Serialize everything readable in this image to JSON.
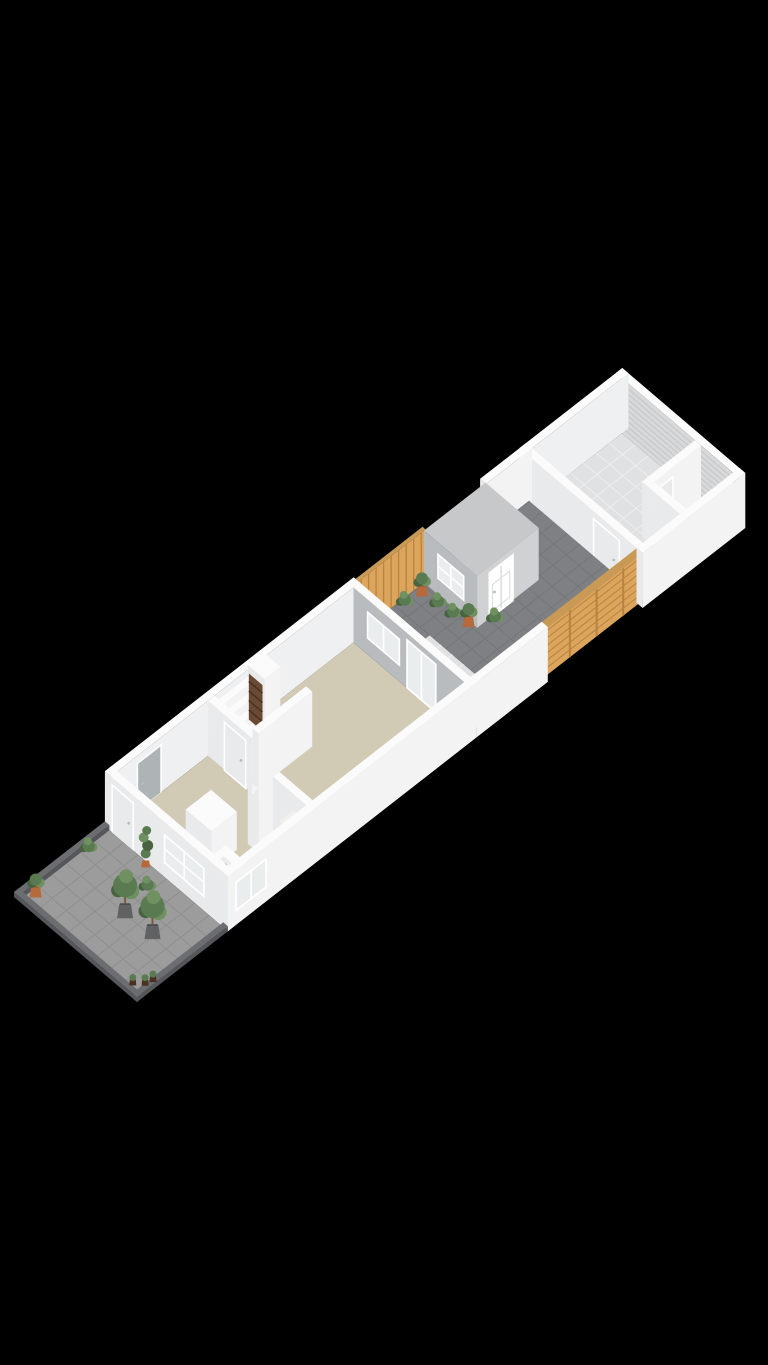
{
  "canvas": {
    "width": 768,
    "height": 1365,
    "background": "#000000",
    "viewbox": "0 0 768 1365"
  },
  "view": {
    "type": "isometric-3d-floorplan",
    "floor_label": ""
  },
  "projection": {
    "origin": [
      137,
      1002
    ],
    "u": [
      0.79,
      -0.6156
    ],
    "v": [
      -0.759,
      -0.648
    ],
    "wall_height": 55
  },
  "palette": {
    "bg": "#000000",
    "white": "#f6f6f7",
    "whiteTop": "#fbfbfc",
    "whiteFaceU": "#e9eaec",
    "whiteFaceV": "#f3f3f4",
    "innerWhite": "#eef0f1",
    "beige": "#d1cab5",
    "tile": "#dfe1e3",
    "tileLine": "#eef0f2",
    "paver": "#7e8083",
    "paverLine": "#737577",
    "terr": "#9c9c9c",
    "terrLine": "#8d8d8d",
    "curb": "#6b6d70",
    "curbSide": "#55575a",
    "wood": "#dca55e",
    "woodDark": "#b9823e",
    "woodTop": "#c99a55",
    "gray": "#b9bcbe",
    "shedSide": "#cfd1d3",
    "roof": "#c6c8ca",
    "glass": "#e9edee",
    "frame": "#ffffff",
    "rib": "#d7d9db",
    "ribLine": "#c5c7c9",
    "smFloor": "#b4b7b9",
    "counterTop": "#ececed",
    "burner": "#3f4143",
    "green": "#5a7a52",
    "greenD": "#47633f",
    "greenL": "#6f9161",
    "terra": "#b66a3c",
    "terraD": "#96522c",
    "planter": "#5f6163",
    "brown": "#6b4a33",
    "brownD": "#4a3122",
    "door": "#e9eaeb",
    "doorOpen": "#aeb3b6",
    "mat": "#f2f1ee"
  },
  "scene": [
    {
      "n": "garage-ribbed-wall",
      "t": "face",
      "ax": "u",
      "at": 762,
      "c": [
        8,
        154
      ],
      "h": [
        0,
        55
      ],
      "f": "rib",
      "stripes": [
        {
          "dir": "h",
          "step": 5.5,
          "col": "ribLine",
          "w": 1.2
        }
      ]
    },
    {
      "n": "garage-far-wall-top",
      "t": "floor",
      "u": [
        762,
        770
      ],
      "v": [
        0,
        162
      ],
      "h": 55,
      "f": "whiteTop"
    },
    {
      "n": "garage-back-wall-inner",
      "t": "face",
      "ax": "v",
      "at": 154,
      "c": [
        640,
        770
      ],
      "h": [
        0,
        55
      ],
      "f": "innerWhite"
    },
    {
      "n": "garage-back-wall-top",
      "t": "floor",
      "u": [
        640,
        770
      ],
      "v": [
        154,
        162
      ],
      "h": 55,
      "f": "whiteTop"
    },
    {
      "n": "garage-floor",
      "t": "floor",
      "u": [
        648,
        762
      ],
      "v": [
        50,
        154
      ],
      "h": 0,
      "f": "tile",
      "grid": [
        16.3,
        17.3,
        "tileLine"
      ]
    },
    {
      "n": "garage-entry-floor",
      "t": "floor",
      "u": [
        648,
        695
      ],
      "v": [
        8,
        50
      ],
      "h": 0,
      "f": "tile",
      "grid": [
        15.6,
        14,
        "tileLine"
      ]
    },
    {
      "n": "storage-room-floor",
      "t": "floor",
      "u": [
        695,
        762
      ],
      "v": [
        8,
        50
      ],
      "h": 0,
      "f": "smFloor"
    },
    {
      "n": "storage-room-wall-long",
      "t": "box",
      "u": [
        695,
        762
      ],
      "v": [
        50,
        58
      ],
      "h": [
        0,
        55
      ]
    },
    {
      "n": "storage-room-door",
      "t": "door",
      "ax": "v",
      "at": 49.5,
      "c": [
        702,
        726
      ],
      "h": [
        0,
        46
      ],
      "f": "door"
    },
    {
      "n": "storage-room-wall-cross",
      "t": "box",
      "u": [
        695,
        703
      ],
      "v": [
        8,
        50
      ],
      "h": [
        0,
        55
      ]
    },
    {
      "n": "garage-front-wall",
      "t": "box",
      "u": [
        640,
        648
      ],
      "v": [
        8,
        162
      ],
      "h": [
        0,
        55
      ]
    },
    {
      "n": "garage-entry-door",
      "t": "door",
      "ax": "u",
      "at": 639.5,
      "c": [
        30,
        64
      ],
      "h": [
        0,
        48
      ],
      "f": "door"
    },
    {
      "n": "courtyard-back-wall",
      "t": "box",
      "u": [
        590,
        648
      ],
      "v": [
        154,
        162
      ],
      "h": [
        0,
        55
      ]
    },
    {
      "n": "courtyard-fence-left",
      "t": "face",
      "ax": "v",
      "at": 158,
      "c": [
        426,
        517
      ],
      "h": [
        0,
        52
      ],
      "f": "wood",
      "stripes": [
        {
          "dir": "plan",
          "step": 9.5,
          "col": "woodDark",
          "w": 1.3
        }
      ]
    },
    {
      "n": "courtyard-fence-left-top",
      "t": "floor",
      "u": [
        426,
        517
      ],
      "v": [
        158,
        162
      ],
      "h": 52,
      "f": "woodTop"
    },
    {
      "n": "courtyard-paving",
      "t": "floor",
      "u": [
        478,
        648
      ],
      "v": [
        8,
        158
      ],
      "h": 0,
      "f": "paver",
      "grid": [
        17,
        16.6,
        "paverLine"
      ]
    },
    {
      "n": "courtyard-paving-upper",
      "t": "floor",
      "u": [
        430,
        478
      ],
      "v": [
        112,
        158
      ],
      "h": 0,
      "f": "paver",
      "grid": [
        16,
        15.3,
        "paverLine"
      ]
    },
    {
      "n": "garden-shed-window-wall",
      "t": "face",
      "ax": "u",
      "at": 515,
      "c": [
        88,
        158
      ],
      "h": [
        0,
        52
      ],
      "f": "gray"
    },
    {
      "n": "garden-shed-window",
      "t": "win",
      "ax": "u",
      "at": 514.5,
      "c": [
        104,
        140
      ],
      "h": [
        16,
        42
      ],
      "mull": [
        2,
        2
      ]
    },
    {
      "n": "garden-shed-side-wall",
      "t": "face",
      "ax": "v",
      "at": 88,
      "c": [
        515,
        593
      ],
      "h": [
        0,
        52
      ],
      "f": "shedSide"
    },
    {
      "n": "garden-shed-door",
      "t": "door",
      "ax": "v",
      "at": 87.5,
      "c": [
        530,
        560
      ],
      "h": [
        0,
        46
      ],
      "f": "frame",
      "panels": true
    },
    {
      "n": "garden-shed-roof",
      "t": "floor",
      "u": [
        515,
        593
      ],
      "v": [
        88,
        158
      ],
      "h": 52,
      "f": "roof"
    },
    {
      "n": "courtyard-plant",
      "t": "plant",
      "k": "bush",
      "p": [
        485,
        152
      ]
    },
    {
      "n": "courtyard-potted-plant",
      "t": "plant",
      "k": "pot",
      "p": [
        503,
        148
      ]
    },
    {
      "n": "courtyard-plant",
      "t": "plant",
      "k": "bush",
      "p": [
        506,
        130
      ]
    },
    {
      "n": "courtyard-plant",
      "t": "plant",
      "k": "bush",
      "p": [
        508,
        112
      ]
    },
    {
      "n": "courtyard-potted-plant",
      "t": "plant",
      "k": "pot",
      "p": [
        510,
        94
      ]
    },
    {
      "n": "courtyard-plant",
      "t": "plant",
      "k": "bush",
      "p": [
        532,
        82
      ]
    },
    {
      "n": "courtyard-fence-right",
      "t": "face",
      "ax": "v",
      "at": 6,
      "c": [
        520,
        655
      ],
      "h": [
        0,
        52
      ],
      "f": "wood",
      "stripes": [
        {
          "dir": "h",
          "step": 7.4,
          "col": "woodDark",
          "w": 1
        },
        {
          "dir": "plan",
          "step": 33.75,
          "col": "woodDark",
          "w": 2
        }
      ]
    },
    {
      "n": "courtyard-fence-right-top",
      "t": "floor",
      "u": [
        520,
        655
      ],
      "v": [
        2,
        10
      ],
      "h": 52,
      "f": "woodTop"
    },
    {
      "n": "garage-right-wall",
      "t": "box",
      "u": [
        640,
        770
      ],
      "v": [
        0,
        8
      ],
      "h": [
        0,
        55
      ]
    },
    {
      "n": "patio-tiles",
      "t": "floor",
      "u": [
        430,
        478
      ],
      "v": [
        8,
        112
      ],
      "h": 0,
      "f": "tile",
      "grid": [
        16,
        14.8,
        "tileLine"
      ]
    },
    {
      "n": "patio-side-wall",
      "t": "box",
      "u": [
        430,
        520
      ],
      "v": [
        0,
        8
      ],
      "h": [
        0,
        55
      ]
    },
    {
      "n": "house-back-wall-inner",
      "t": "face",
      "ax": "v",
      "at": 154,
      "c": [
        115,
        430
      ],
      "h": [
        0,
        55
      ],
      "f": "innerWhite"
    },
    {
      "n": "house-back-window",
      "t": "win",
      "ax": "v",
      "at": 153.5,
      "c": [
        256,
        290
      ],
      "h": [
        18,
        44
      ],
      "mull": [
        2,
        1
      ]
    },
    {
      "n": "house-back-doorway",
      "t": "door",
      "ax": "v",
      "at": 153.5,
      "c": [
        148,
        178
      ],
      "h": [
        0,
        48
      ],
      "f": "doorOpen"
    },
    {
      "n": "house-back-wall-top",
      "t": "floor",
      "u": [
        115,
        430
      ],
      "v": [
        154,
        162
      ],
      "h": 55,
      "f": "whiteTop"
    },
    {
      "n": "living-room-floor",
      "t": "floor",
      "u": [
        123,
        422
      ],
      "v": [
        8,
        154
      ],
      "h": 0,
      "f": "beige"
    },
    {
      "n": "kitchen-tall-cabinet",
      "t": "box",
      "u": [
        152,
        184
      ],
      "v": [
        60,
        94
      ],
      "h": [
        0,
        38
      ]
    },
    {
      "n": "kitchen-counter",
      "t": "box",
      "u": [
        122,
        168
      ],
      "v": [
        10,
        58
      ],
      "h": [
        0,
        16
      ]
    },
    {
      "n": "kitchen-cooktop",
      "t": "floor",
      "u": [
        130,
        158
      ],
      "v": [
        18,
        50
      ],
      "h": 16,
      "f": "counterTop"
    },
    {
      "n": "cooktop-burners",
      "t": "dots",
      "h": 16,
      "r": 2.6,
      "f": "burner",
      "pts": [
        [
          137,
          26
        ],
        [
          137,
          42
        ],
        [
          151,
          26
        ],
        [
          151,
          42
        ]
      ]
    },
    {
      "n": "wc-wall",
      "t": "box",
      "u": [
        196,
        204
      ],
      "v": [
        8,
        58
      ],
      "h": [
        0,
        55
      ]
    },
    {
      "n": "wc-wall",
      "t": "box",
      "u": [
        222,
        230
      ],
      "v": [
        8,
        58
      ],
      "h": [
        0,
        55
      ]
    },
    {
      "n": "wc-wall",
      "t": "box",
      "u": [
        204,
        222
      ],
      "v": [
        52,
        58
      ],
      "h": [
        0,
        55
      ]
    },
    {
      "n": "doormat",
      "t": "floor",
      "u": [
        234,
        252
      ],
      "v": [
        36,
        56
      ],
      "h": 0.4,
      "f": "mat"
    },
    {
      "n": "staircase",
      "t": "steps",
      "u": [
        246,
        290
      ],
      "vTop": 154,
      "nSteps": 6,
      "dv": 7,
      "dh": 8
    },
    {
      "n": "meter-closet",
      "t": "box",
      "u": [
        292,
        312
      ],
      "v": [
        136,
        158
      ],
      "h": [
        0,
        55
      ]
    },
    {
      "n": "meter-closet-shelves",
      "t": "face",
      "ax": "u",
      "at": 291.5,
      "c": [
        138,
        156
      ],
      "h": [
        2,
        48
      ],
      "f": "brown",
      "stripes": [
        {
          "dir": "h",
          "step": 9.5,
          "col": "brownD",
          "w": 1.5
        }
      ]
    },
    {
      "n": "hall-wall",
      "t": "box",
      "u": [
        238,
        246
      ],
      "v": [
        96,
        154
      ],
      "h": [
        0,
        55
      ]
    },
    {
      "n": "hall-door",
      "t": "door",
      "ax": "u",
      "at": 237.5,
      "c": [
        104,
        132
      ],
      "h": [
        0,
        48
      ],
      "f": "door"
    },
    {
      "n": "hall-wall",
      "t": "box",
      "u": [
        246,
        314
      ],
      "v": [
        96,
        104
      ],
      "h": [
        0,
        55
      ]
    },
    {
      "n": "rear-gray-wall",
      "t": "box",
      "u": [
        422,
        430
      ],
      "v": [
        8,
        154
      ],
      "h": [
        0,
        55
      ],
      "fu": "gray"
    },
    {
      "n": "rear-wall-window",
      "t": "win",
      "ax": "u",
      "at": 421.5,
      "c": [
        92,
        136
      ],
      "h": [
        16,
        44
      ],
      "mull": [
        2,
        1
      ]
    },
    {
      "n": "rear-glass-door",
      "t": "win",
      "ax": "u",
      "at": 421.5,
      "c": [
        44,
        84
      ],
      "h": [
        0,
        50
      ],
      "mull": [
        2,
        1
      ]
    },
    {
      "n": "house-front-wall",
      "t": "box",
      "u": [
        115,
        430
      ],
      "v": [
        0,
        8
      ],
      "h": [
        0,
        55
      ]
    },
    {
      "n": "kitchen-window",
      "t": "win",
      "ax": "v",
      "at": -0.5,
      "c": [
        124,
        164
      ],
      "h": [
        14,
        44
      ],
      "mull": [
        2,
        1
      ]
    },
    {
      "n": "house-left-wall",
      "t": "box",
      "u": [
        115,
        123
      ],
      "v": [
        0,
        162
      ],
      "h": [
        0,
        55
      ]
    },
    {
      "n": "left-wall-window",
      "t": "win",
      "ax": "u",
      "at": 114.5,
      "c": [
        30,
        84
      ],
      "h": [
        14,
        44
      ],
      "mull": [
        2,
        2
      ]
    },
    {
      "n": "front-door",
      "t": "door",
      "ax": "u",
      "at": 114.5,
      "c": [
        124,
        152
      ],
      "h": [
        0,
        48
      ],
      "f": "door"
    },
    {
      "n": "terrace-back-curb",
      "t": "box",
      "u": [
        0,
        115
      ],
      "v": [
        156,
        162
      ],
      "h": [
        0,
        5
      ],
      "ft": "curb",
      "fu": "curbSide",
      "fv": "curbSide"
    },
    {
      "n": "terrace-paving",
      "t": "floor",
      "u": [
        6,
        115
      ],
      "v": [
        6,
        156
      ],
      "h": 0,
      "f": "terr",
      "grid": [
        18.2,
        18.7,
        "terrLine"
      ]
    },
    {
      "n": "terrace-left-curb",
      "t": "box",
      "u": [
        0,
        6
      ],
      "v": [
        0,
        162
      ],
      "h": [
        0,
        5
      ],
      "ft": "curb",
      "fu": "curbSide",
      "fv": "curbSide"
    },
    {
      "n": "terrace-front-curb",
      "t": "box",
      "u": [
        0,
        115
      ],
      "v": [
        0,
        6
      ],
      "h": [
        0,
        5
      ],
      "ft": "curb",
      "fu": "curbSide",
      "fv": "curbSide"
    },
    {
      "n": "terrace-plant",
      "t": "plant",
      "k": "bush",
      "p": [
        85,
        152
      ]
    },
    {
      "n": "terrace-potted-plant",
      "t": "plant",
      "k": "pot",
      "p": [
        14,
        148
      ]
    },
    {
      "n": "terrace-tall-plant",
      "t": "plant",
      "k": "tall",
      "p": [
        110,
        103
      ]
    },
    {
      "n": "terrace-plant",
      "t": "plant",
      "k": "bush",
      "p": [
        94,
        84
      ]
    },
    {
      "n": "terrace-tree",
      "t": "plant",
      "k": "tree",
      "p": [
        57,
        75
      ]
    },
    {
      "n": "terrace-tree",
      "t": "plant",
      "k": "tree",
      "p": [
        59,
        41
      ]
    },
    {
      "n": "terrace-small-pot",
      "t": "plant",
      "k": "spot",
      "p": [
        10,
        16
      ]
    },
    {
      "n": "terrace-small-pot",
      "t": "plant",
      "k": "spot",
      "p": [
        18,
        8
      ]
    },
    {
      "n": "terrace-small-pot",
      "t": "plant",
      "k": "spot",
      "p": [
        26,
        6
      ]
    }
  ]
}
